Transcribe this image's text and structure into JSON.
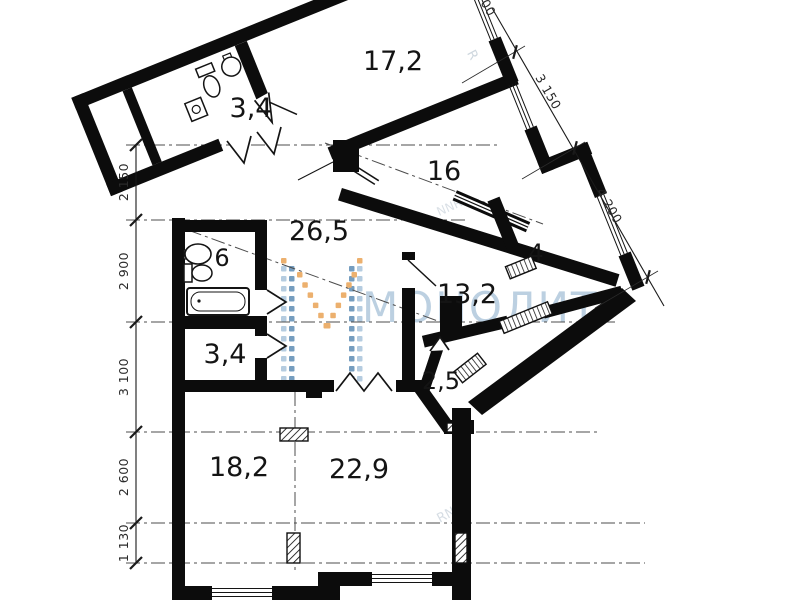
{
  "plan_type": "apartment-floor-plan",
  "rooms": [
    {
      "id": "wc-top",
      "area": "3,4"
    },
    {
      "id": "bedroom-1",
      "area": "17,2"
    },
    {
      "id": "bedroom-2",
      "area": "16"
    },
    {
      "id": "hall",
      "area": "26,5"
    },
    {
      "id": "bathroom",
      "area": "6"
    },
    {
      "id": "storage",
      "area": "4"
    },
    {
      "id": "bedroom-3",
      "area": "13,2"
    },
    {
      "id": "wc-lower",
      "area": "3,4"
    },
    {
      "id": "balcony",
      "area": "2,5"
    },
    {
      "id": "zone-kitchen",
      "area": "18,2"
    },
    {
      "id": "zone-living",
      "area": "22,9"
    }
  ],
  "dimensions": {
    "left": [
      "2 150",
      "2 900",
      "3 100",
      "2 600",
      "1 130"
    ],
    "right": [
      "3 150",
      "4 200"
    ],
    "top_partial": "00"
  },
  "watermark": {
    "brand": "МОНОЛИТ",
    "fragments": [
      "R",
      "NNR",
      "RNN"
    ],
    "colors": {
      "text": "#b9cee0",
      "light_blue": "#a9c4db",
      "blue": "#5e8db5",
      "orange": "#e9a355"
    }
  }
}
